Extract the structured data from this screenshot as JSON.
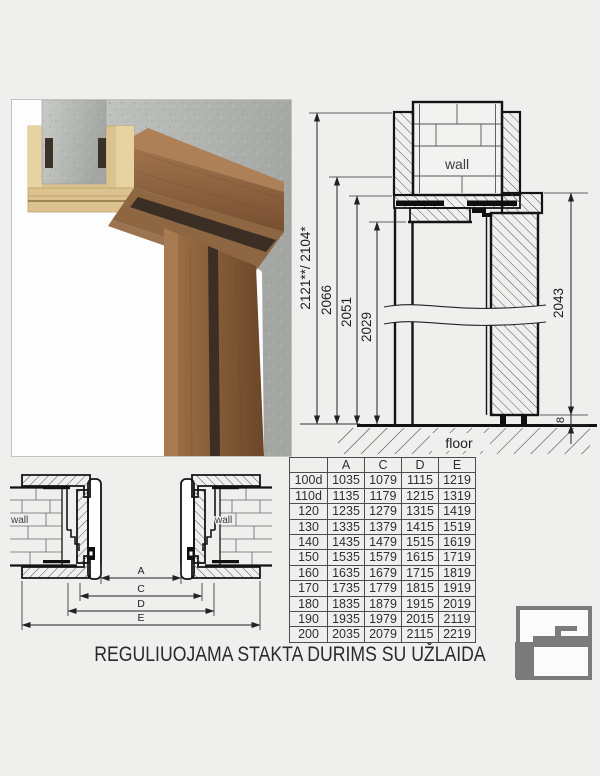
{
  "title": "REGULIUOJAMA STAKTA DURIMS SU UŽLAIDA",
  "colors": {
    "background": "#efefee",
    "line": "#141414",
    "wood_dark": "#7a5132",
    "wood_light": "#dbc28e",
    "concrete": "#b4b6b3",
    "logo_gray": "#7b7b7b"
  },
  "photo": {
    "description": "door-frame-corner-render"
  },
  "vertical_section": {
    "wall_label": "wall",
    "floor_label": "floor",
    "dim_total": "2121**/ 2104*",
    "dim_2066": "2066",
    "dim_2051": "2051",
    "dim_2029": "2029",
    "dim_door": "2043",
    "dim_gap": "8"
  },
  "horizontal_section": {
    "wall_left_label": "wall",
    "wall_right_label": "wall",
    "dim_a": "A",
    "dim_c": "C",
    "dim_d": "D",
    "dim_e": "E"
  },
  "table": {
    "headers": [
      "",
      "A",
      "C",
      "D",
      "E"
    ],
    "rows": [
      [
        "100d",
        "1035",
        "1079",
        "1115",
        "1219"
      ],
      [
        "110d",
        "1135",
        "1179",
        "1215",
        "1319"
      ],
      [
        "120",
        "1235",
        "1279",
        "1315",
        "1419"
      ],
      [
        "130",
        "1335",
        "1379",
        "1415",
        "1519"
      ],
      [
        "140",
        "1435",
        "1479",
        "1515",
        "1619"
      ],
      [
        "150",
        "1535",
        "1579",
        "1615",
        "1719"
      ],
      [
        "160",
        "1635",
        "1679",
        "1715",
        "1819"
      ],
      [
        "170",
        "1735",
        "1779",
        "1815",
        "1919"
      ],
      [
        "180",
        "1835",
        "1879",
        "1915",
        "2019"
      ],
      [
        "190",
        "1935",
        "1979",
        "2015",
        "2119"
      ],
      [
        "200",
        "2035",
        "2079",
        "2115",
        "2219"
      ]
    ]
  }
}
